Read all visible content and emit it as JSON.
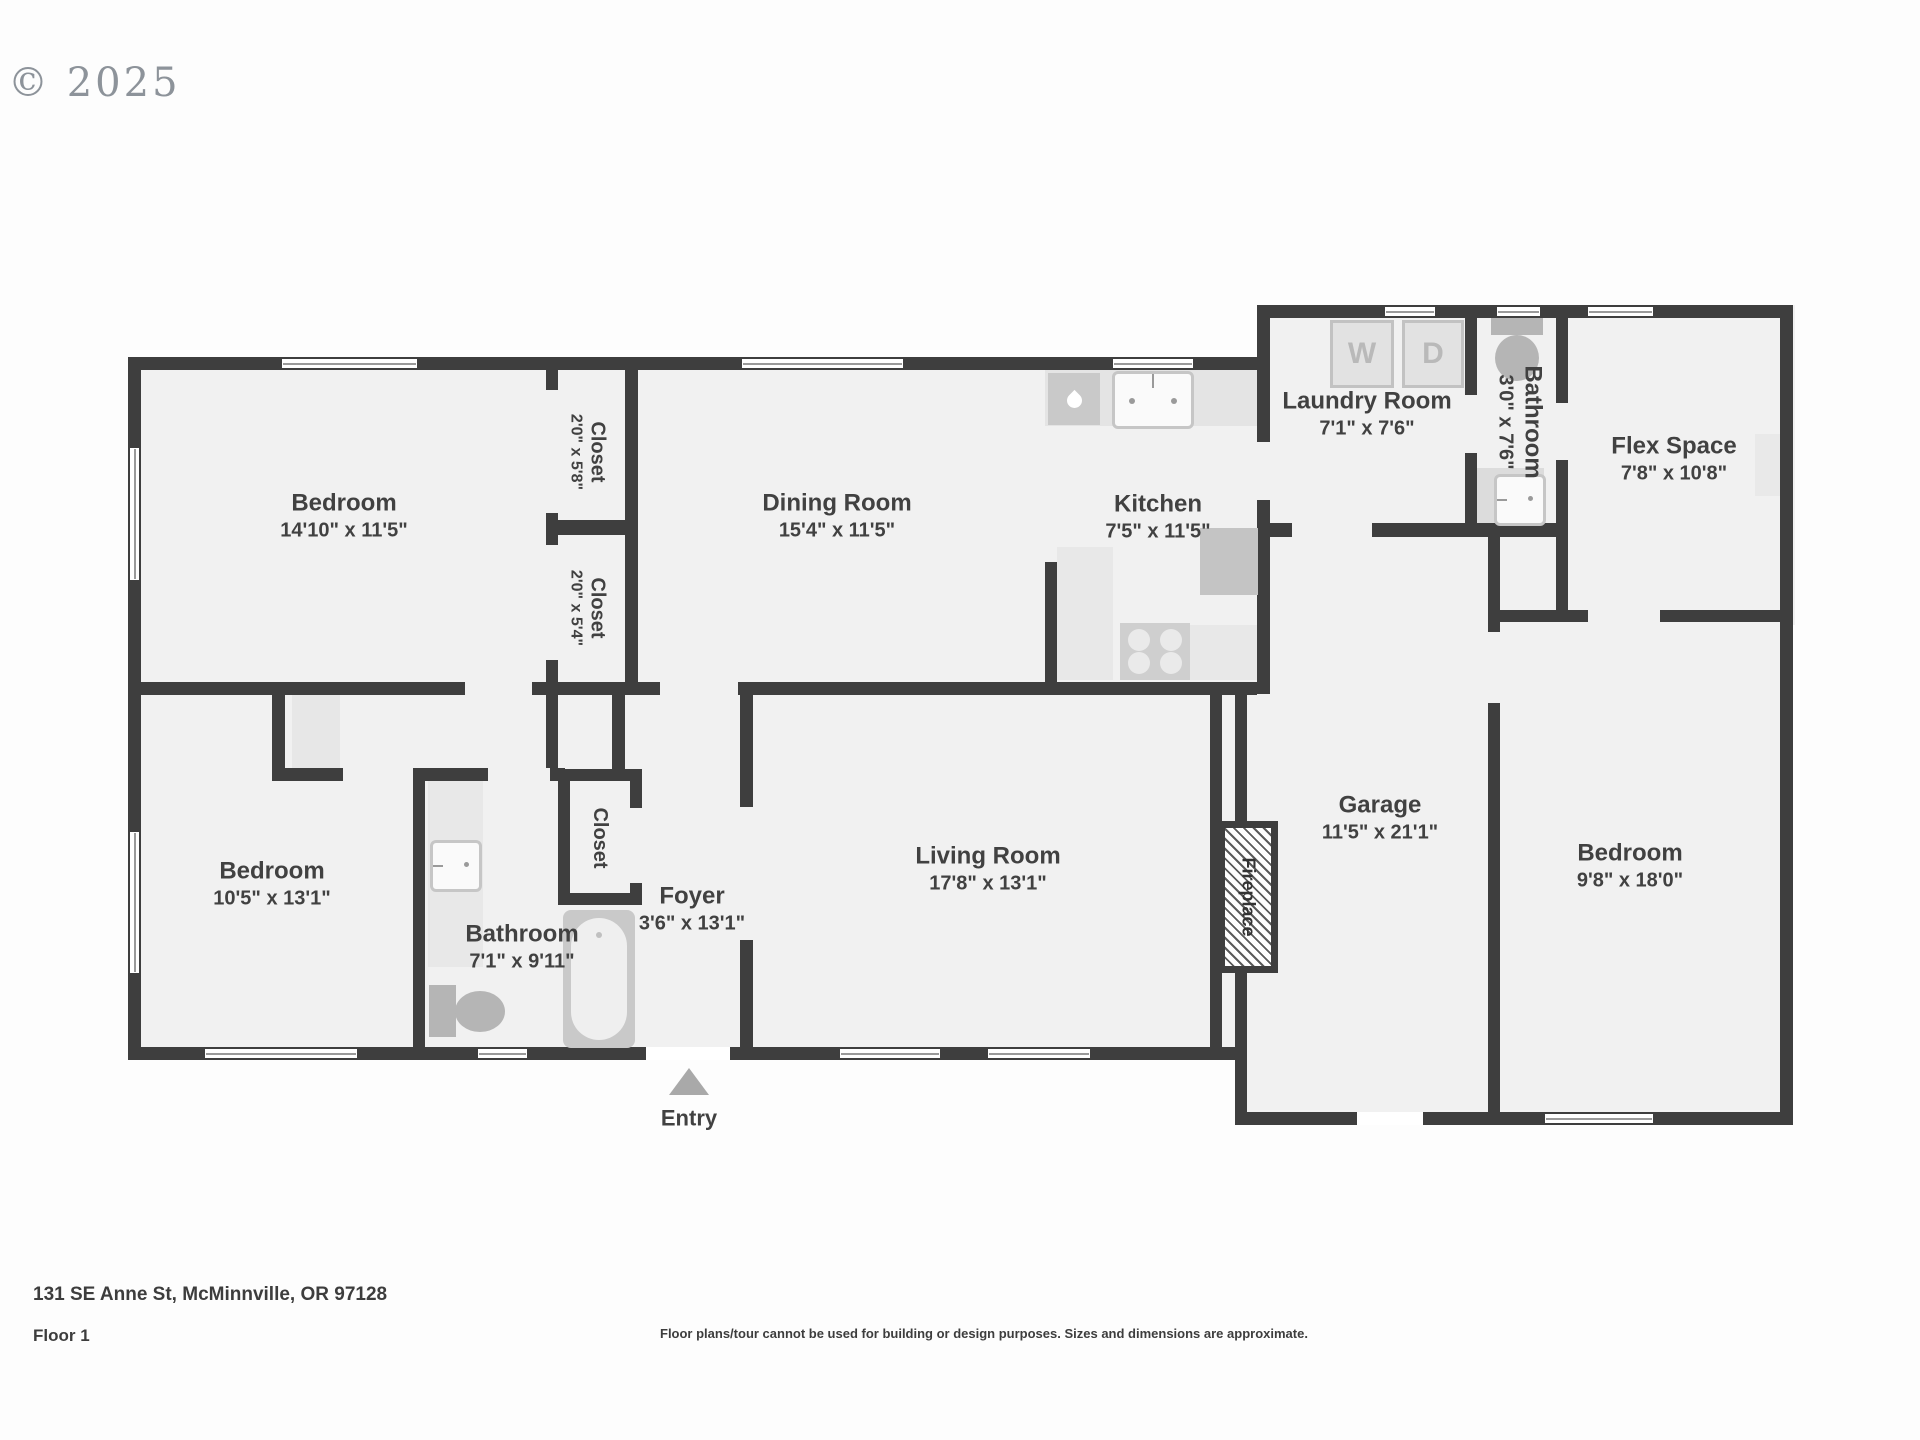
{
  "watermark": "© 2025",
  "footer": {
    "address": "131 SE Anne St, McMinnville, OR 97128",
    "floor": "Floor 1",
    "disclaimer": "Floor plans/tour cannot be used for building or design purposes. Sizes and dimensions are approximate."
  },
  "entry": {
    "label": "Entry"
  },
  "colors": {
    "wall": "#3e3e3e",
    "floor": "#f1f1f1",
    "fixture_gray": "#b5b5b5",
    "entry_arrow": "#a9a9a9"
  },
  "appliances": {
    "washer": "W",
    "dryer": "D"
  },
  "rooms": [
    {
      "name": "Bedroom",
      "dims": "14'10\" x 11'5\""
    },
    {
      "name": "Closet",
      "dims": "2'0\" x 5'8\""
    },
    {
      "name": "Closet",
      "dims": "2'0\" x 5'4\""
    },
    {
      "name": "Dining Room",
      "dims": "15'4\" x 11'5\""
    },
    {
      "name": "Kitchen",
      "dims": "7'5\" x 11'5\""
    },
    {
      "name": "Laundry Room",
      "dims": "7'1\" x 7'6\""
    },
    {
      "name": "Bathroom",
      "dims": "3'0\" x 7'6\""
    },
    {
      "name": "Flex Space",
      "dims": "7'8\" x 10'8\""
    },
    {
      "name": "Bedroom",
      "dims": "10'5\" x 13'1\""
    },
    {
      "name": "Bathroom",
      "dims": "7'1\" x 9'11\""
    },
    {
      "name": "Closet",
      "dims": ""
    },
    {
      "name": "Foyer",
      "dims": "3'6\" x 13'1\""
    },
    {
      "name": "Living Room",
      "dims": "17'8\" x 13'1\""
    },
    {
      "name": "Garage",
      "dims": "11'5\" x 21'1\""
    },
    {
      "name": "Fireplace",
      "dims": ""
    },
    {
      "name": "Bedroom",
      "dims": "9'8\" x 18'0\""
    }
  ]
}
